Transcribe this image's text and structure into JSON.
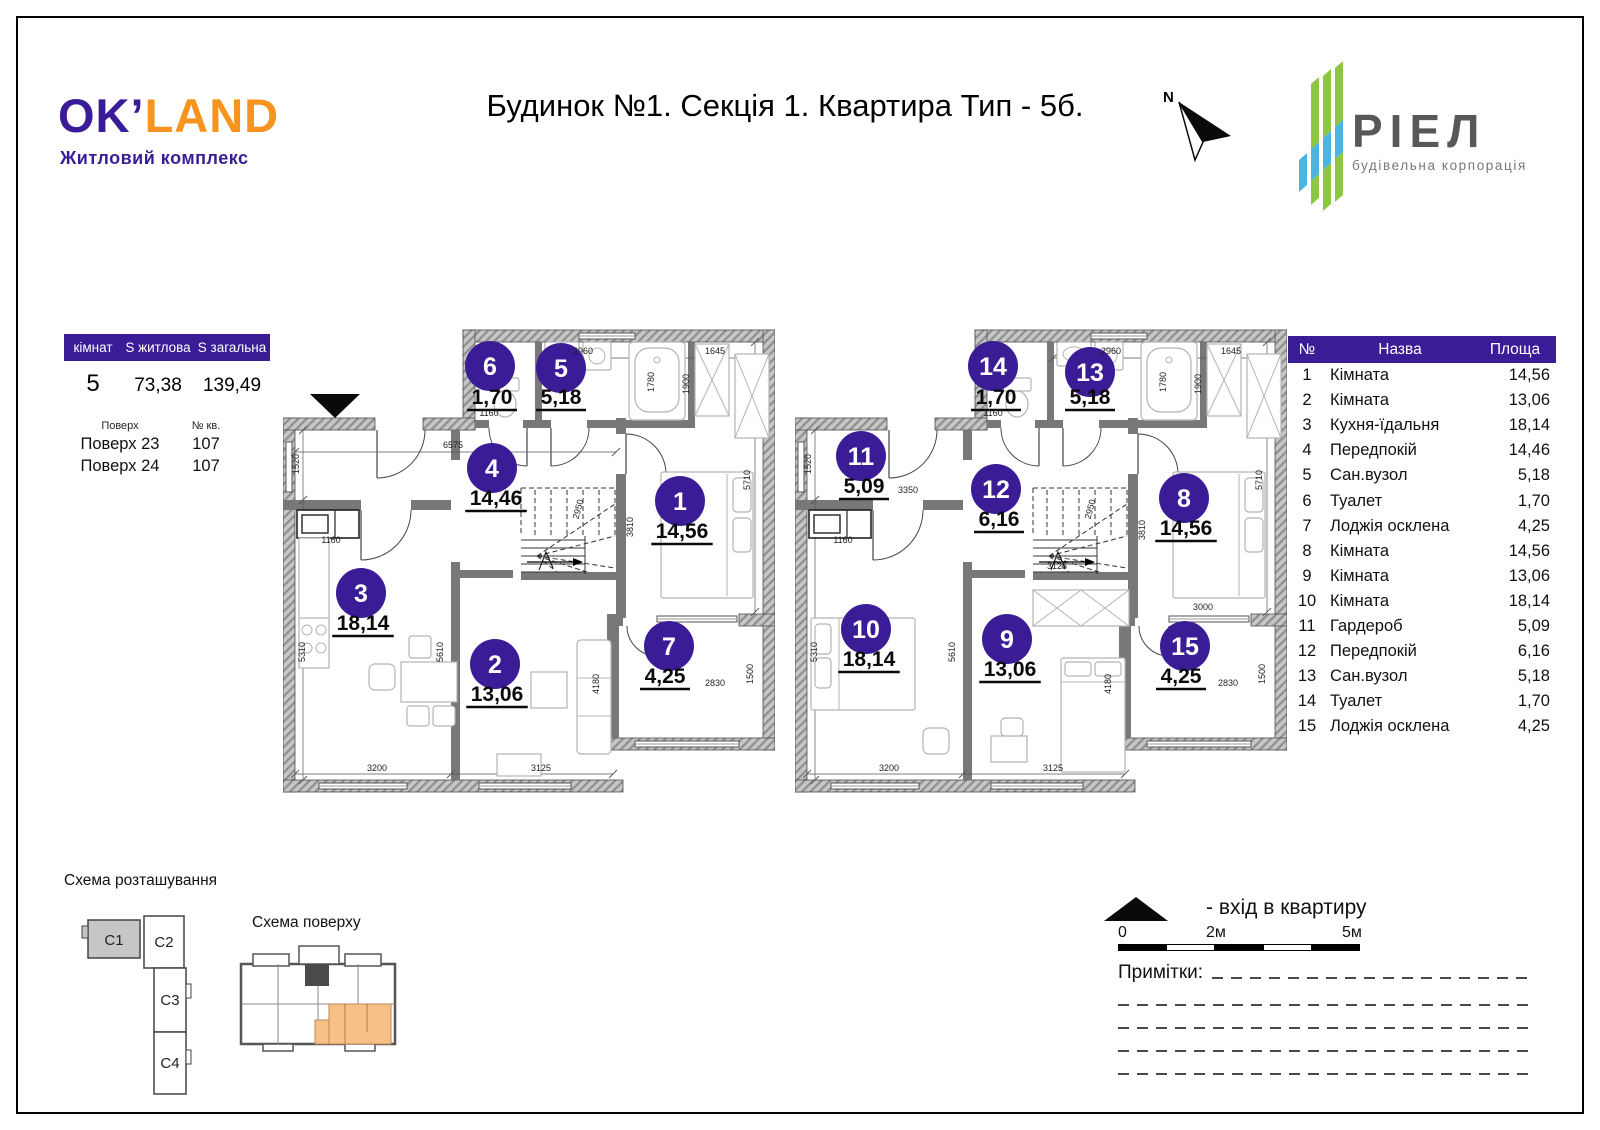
{
  "page": {
    "title": "Будинок №1. Секція 1. Квартира Тип - 5б.",
    "north_label": "N"
  },
  "brand": {
    "okland": {
      "part1": "OK’",
      "part2": "LAND",
      "subtitle": "Житловий комплекс"
    },
    "riel": {
      "name": "РІЕЛ",
      "subtitle": "будівельна корпорація"
    }
  },
  "summary_table": {
    "headers": [
      "кімнат",
      "S житлова",
      "S загальна"
    ],
    "values": [
      "5",
      "73,38",
      "139,49"
    ],
    "floors_header": [
      "Поверх",
      "№ кв."
    ],
    "floors": [
      [
        "Поверх 23",
        "107"
      ],
      [
        "Поверх 24",
        "107"
      ]
    ]
  },
  "rooms_table": {
    "headers": [
      "№",
      "Назва",
      "Площа"
    ],
    "rows": [
      [
        "1",
        "Кімната",
        "14,56"
      ],
      [
        "2",
        "Кімната",
        "13,06"
      ],
      [
        "3",
        "Кухня-їдальня",
        "18,14"
      ],
      [
        "4",
        "Передпокій",
        "14,46"
      ],
      [
        "5",
        "Сан.вузол",
        "5,18"
      ],
      [
        "6",
        "Туалет",
        "1,70"
      ],
      [
        "7",
        "Лоджія осклена",
        "4,25"
      ],
      [
        "8",
        "Кімната",
        "14,56"
      ],
      [
        "9",
        "Кімната",
        "13,06"
      ],
      [
        "10",
        "Кімната",
        "18,14"
      ],
      [
        "11",
        "Гардероб",
        "5,09"
      ],
      [
        "12",
        "Передпокій",
        "6,16"
      ],
      [
        "13",
        "Сан.вузол",
        "5,18"
      ],
      [
        "14",
        "Туалет",
        "1,70"
      ],
      [
        "15",
        "Лоджія осклена",
        "4,25"
      ]
    ]
  },
  "plan1": {
    "entrance": true,
    "rooms": [
      {
        "n": "6",
        "cx": 207,
        "cy": 44,
        "area": "1,70",
        "ax": 209,
        "ay": 82
      },
      {
        "n": "5",
        "cx": 278,
        "cy": 46,
        "area": "5,18",
        "ax": 278,
        "ay": 82
      },
      {
        "n": "4",
        "cx": 209,
        "cy": 146,
        "area": "14,46",
        "ax": 213,
        "ay": 183
      },
      {
        "n": "1",
        "cx": 397,
        "cy": 179,
        "area": "14,56",
        "ax": 399,
        "ay": 216
      },
      {
        "n": "3",
        "cx": 78,
        "cy": 271,
        "area": "18,14",
        "ax": 80,
        "ay": 308
      },
      {
        "n": "2",
        "cx": 212,
        "cy": 342,
        "area": "13,06",
        "ax": 214,
        "ay": 379
      },
      {
        "n": "7",
        "cx": 386,
        "cy": 324,
        "area": "4,25",
        "ax": 382,
        "ay": 361
      }
    ],
    "dims": [
      {
        "t": "6575",
        "x": 170,
        "y": 126,
        "r": 0
      },
      {
        "t": "1520",
        "x": 16,
        "y": 142,
        "r": -90
      },
      {
        "t": "1160",
        "x": 48,
        "y": 221,
        "r": 0
      },
      {
        "t": "1160",
        "x": 206,
        "y": 94,
        "r": 0
      },
      {
        "t": "5310",
        "x": 22,
        "y": 330,
        "r": -90
      },
      {
        "t": "5610",
        "x": 160,
        "y": 330,
        "r": -90
      },
      {
        "t": "3200",
        "x": 94,
        "y": 449,
        "r": 0
      },
      {
        "t": "3125",
        "x": 258,
        "y": 449,
        "r": 0
      },
      {
        "t": "4180",
        "x": 316,
        "y": 362,
        "r": -90
      },
      {
        "t": "2950",
        "x": 298,
        "y": 188,
        "r": -75
      },
      {
        "t": "3810",
        "x": 350,
        "y": 205,
        "r": -90
      },
      {
        "t": "2960",
        "x": 300,
        "y": 32,
        "r": 0
      },
      {
        "t": "1645",
        "x": 432,
        "y": 32,
        "r": 0
      },
      {
        "t": "1780",
        "x": 371,
        "y": 60,
        "r": -90
      },
      {
        "t": "1900",
        "x": 406,
        "y": 62,
        "r": -90
      },
      {
        "t": "5710",
        "x": 467,
        "y": 158,
        "r": -90
      },
      {
        "t": "1500",
        "x": 470,
        "y": 352,
        "r": -90
      },
      {
        "t": "2830",
        "x": 432,
        "y": 364,
        "r": 0
      }
    ]
  },
  "plan2": {
    "entrance": false,
    "rooms": [
      {
        "n": "14",
        "cx": 198,
        "cy": 44,
        "area": "1,70",
        "ax": 201,
        "ay": 82
      },
      {
        "n": "13",
        "cx": 295,
        "cy": 50,
        "area": "5,18",
        "ax": 295,
        "ay": 82
      },
      {
        "n": "11",
        "cx": 66,
        "cy": 134,
        "area": "5,09",
        "ax": 69,
        "ay": 171
      },
      {
        "n": "12",
        "cx": 201,
        "cy": 167,
        "area": "6,16",
        "ax": 204,
        "ay": 204
      },
      {
        "n": "8",
        "cx": 389,
        "cy": 176,
        "area": "14,56",
        "ax": 391,
        "ay": 213
      },
      {
        "n": "10",
        "cx": 71,
        "cy": 307,
        "area": "18,14",
        "ax": 74,
        "ay": 344
      },
      {
        "n": "9",
        "cx": 212,
        "cy": 317,
        "area": "13,06",
        "ax": 215,
        "ay": 354
      },
      {
        "n": "15",
        "cx": 390,
        "cy": 324,
        "area": "4,25",
        "ax": 386,
        "ay": 361
      }
    ],
    "dims": [
      {
        "t": "1520",
        "x": 16,
        "y": 142,
        "r": -90
      },
      {
        "t": "3350",
        "x": 113,
        "y": 171,
        "r": 0
      },
      {
        "t": "1160",
        "x": 48,
        "y": 221,
        "r": 0
      },
      {
        "t": "1160",
        "x": 198,
        "y": 94,
        "r": 0
      },
      {
        "t": "5310",
        "x": 22,
        "y": 330,
        "r": -90
      },
      {
        "t": "5610",
        "x": 160,
        "y": 330,
        "r": -90
      },
      {
        "t": "3200",
        "x": 94,
        "y": 449,
        "r": 0
      },
      {
        "t": "3125",
        "x": 258,
        "y": 449,
        "r": 0
      },
      {
        "t": "3125",
        "x": 262,
        "y": 247,
        "r": 0
      },
      {
        "t": "4180",
        "x": 316,
        "y": 362,
        "r": -90
      },
      {
        "t": "2950",
        "x": 298,
        "y": 188,
        "r": -75
      },
      {
        "t": "3810",
        "x": 350,
        "y": 208,
        "r": -90
      },
      {
        "t": "2960",
        "x": 316,
        "y": 32,
        "r": 0
      },
      {
        "t": "1645",
        "x": 436,
        "y": 32,
        "r": 0
      },
      {
        "t": "1780",
        "x": 371,
        "y": 60,
        "r": -90
      },
      {
        "t": "1900",
        "x": 406,
        "y": 62,
        "r": -90
      },
      {
        "t": "5710",
        "x": 467,
        "y": 158,
        "r": -90
      },
      {
        "t": "3000",
        "x": 408,
        "y": 288,
        "r": 0
      },
      {
        "t": "1500",
        "x": 470,
        "y": 352,
        "r": -90
      },
      {
        "t": "2830",
        "x": 433,
        "y": 364,
        "r": 0
      }
    ]
  },
  "location_scheme": {
    "label": "Схема розташування",
    "sections": [
      "С1",
      "С2",
      "С3",
      "С4"
    ],
    "highlighted": "С1"
  },
  "floor_scheme": {
    "label": "Схема поверху"
  },
  "legend": {
    "entrance_label": "-  вхід в квартиру",
    "scale_labels": [
      "0",
      "2м",
      "5м"
    ],
    "notes_label": "Примітки:"
  },
  "colors": {
    "purple": "#3a1d96",
    "orange": "#f7941e",
    "green": "#8dc63f",
    "blue": "#4ab5e2",
    "wall_gray": "#787878",
    "highlight": "#f6c186",
    "section_fill": "#c6c6c6",
    "riel_text": "#58585a"
  }
}
